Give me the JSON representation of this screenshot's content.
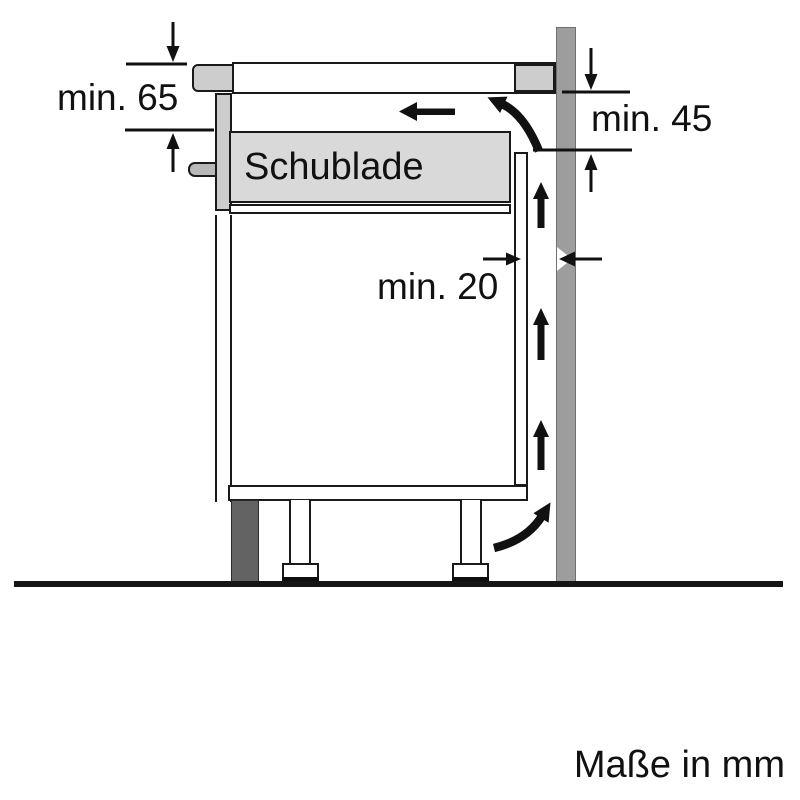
{
  "labels": {
    "dim_left": "min. 65",
    "dim_right": "min. 45",
    "dim_gap": "min. 20",
    "drawer": "Schublade",
    "units": "Maße in mm"
  },
  "arrows": {
    "airflow": [
      "air-out-left-arrow",
      "air-out-curve-arrow",
      "air-up-arrow-1",
      "air-up-arrow-2",
      "air-up-arrow-3",
      "air-in-curve-arrow"
    ],
    "dimensions": [
      "min65-down-arrow",
      "min65-up-arrow",
      "min45-down-arrow",
      "min45-up-arrow",
      "min20-right-arrow",
      "min20-left-arrow"
    ]
  },
  "colors": {
    "line": "#1a1a1a",
    "light_gray_fill": "#d9d9d9",
    "wall_gray": "#9d9d9d",
    "plinth_gray": "#636363",
    "background": "#ffffff"
  }
}
